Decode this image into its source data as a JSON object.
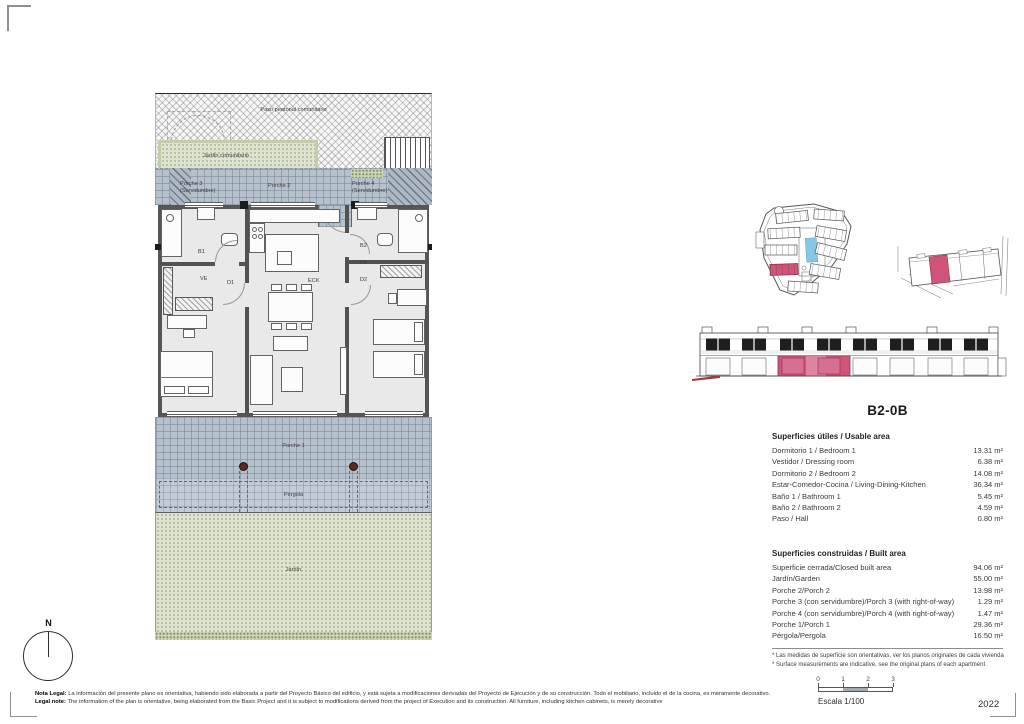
{
  "document": {
    "title": "B2-0B",
    "year": "2022",
    "north_label": "N"
  },
  "scalebar": {
    "label": "Escala 1/100",
    "ticks": [
      "0",
      "1",
      "2",
      "3"
    ]
  },
  "plan": {
    "labels": {
      "paso": "Paso peatonal comunitario",
      "jardin_com": "Jardín comunitario",
      "porche3_l1": "Porche 3",
      "porche3_l2": "(Servidumbre)",
      "porche2": "Porche 2",
      "porche4_l1": "Porche 4",
      "porche4_l2": "(Servidumbre)",
      "b1": "B1",
      "ve": "VE",
      "d1": "D1",
      "eck": "ECK",
      "b2": "B2",
      "pa": "PA",
      "d2": "D2",
      "porche1": "Porche 1",
      "pergola": "Pérgola",
      "jardin": "Jardín"
    }
  },
  "tables": {
    "usable": {
      "title": "Superficies útiles / Usable area",
      "rows": [
        [
          "Dormitorio 1 / Bedroom 1",
          "13.31 m²"
        ],
        [
          "Vestidor / Dressing room",
          "6.38 m²"
        ],
        [
          "Dormitorio 2 / Bedroom 2",
          "14.08 m²"
        ],
        [
          "Estar-Comedor-Cocina / Living-Dining-Kitchen",
          "36.34 m²"
        ],
        [
          "Baño 1 / Bathroom 1",
          "5.45 m²"
        ],
        [
          "Baño 2 / Bathroom 2",
          "4.59 m²"
        ],
        [
          "Paso / Hall",
          "0.80 m²"
        ]
      ]
    },
    "built": {
      "title": "Superficies construidas / Built area",
      "rows": [
        [
          "Superficie cerrada/Closed built area",
          "94.06 m²"
        ],
        [
          "Jardín/Garden",
          "55.00 m²"
        ],
        [
          "Porche 2/Porch 2",
          "13.98 m²"
        ],
        [
          "Porche 3 (con servidumbre)/Porch 3 (with right-of-way)",
          "1.29 m²"
        ],
        [
          "Porche 4 (con servidumbre)/Porch 4 (with right-of-way)",
          "1.47 m²"
        ],
        [
          "Porche 1/Porch 1",
          "29.36 m²"
        ],
        [
          "Pérgola/Pergola",
          "16.50 m²"
        ]
      ]
    },
    "footnotes": [
      "* Las medidas de superficie son orientativas, ver los planos originales de cada vivienda",
      "* Surface measurements are indicative, see the original plans of each apartment"
    ]
  },
  "legal": {
    "es_label": "Nota Legal:",
    "es": "La información del presente plano es orientativa, habiendo sido elaborada a partir del Proyecto Básico del edificio, y está sujeta a modificaciones derivadas del Proyecto de Ejecución y de su construcción. Todo el mobiliario, incluido el de la cocina, es meramente decorativo.",
    "en_label": "Legal note:",
    "en": "The information of the plan is orientative, being elaborated from the Basic Project and it is subject to modifications derived from the project of Execution and its construction. All furniture, including kitchen cabinets, is merely decorative"
  },
  "colors": {
    "highlight_pink": "#cf5578",
    "pool_blue": "#86c7e6",
    "porch_tile": "#b7c1cc",
    "garden_green": "#dfe4d1",
    "column_red": "#5d2a23"
  }
}
